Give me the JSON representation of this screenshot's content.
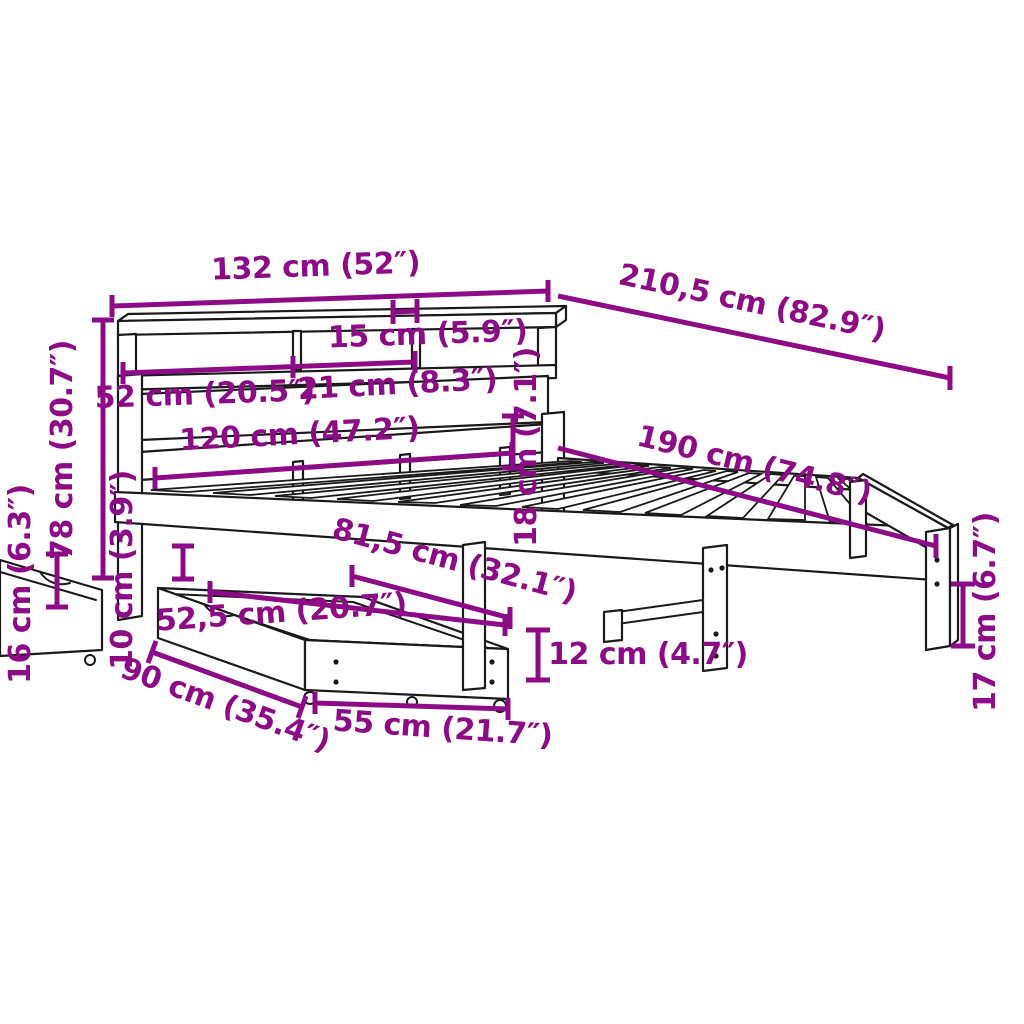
{
  "colors": {
    "dimension": "#8e0b87",
    "line_art": "#1a1a1a",
    "background": "#ffffff"
  },
  "dims": [
    {
      "id": "headboard-width",
      "label": "132 cm (52″)"
    },
    {
      "id": "total-length",
      "label": "210,5 cm (82.9″)"
    },
    {
      "id": "shelf-slot-width",
      "label": "15 cm (5.9″)"
    },
    {
      "id": "shelf-left-compartment",
      "label": "52 cm (20.5″)"
    },
    {
      "id": "shelf-mid-compartment",
      "label": "21 cm (8.3″)"
    },
    {
      "id": "inner-width",
      "label": "120 cm (47.2″)"
    },
    {
      "id": "frame-height",
      "label": "18 cm (7.1″)"
    },
    {
      "id": "mattress-length",
      "label": "190 cm (74.8″)"
    },
    {
      "id": "headboard-height",
      "label": "78 cm (30.7″)"
    },
    {
      "id": "ground-clearance",
      "label": "16 cm (6.3″)"
    },
    {
      "id": "gap-under-rail",
      "label": "10 cm (3.9″)"
    },
    {
      "id": "underbed-depth",
      "label": "81,5 cm (32.1″)"
    },
    {
      "id": "drawer-inner-width",
      "label": "52,5 cm (20.7″)"
    },
    {
      "id": "drawer-depth",
      "label": "90 cm (35.4″)"
    },
    {
      "id": "drawer-front-width",
      "label": "55 cm (21.7″)"
    },
    {
      "id": "drawer-height",
      "label": "12 cm (4.7″)"
    },
    {
      "id": "leg-height",
      "label": "17 cm (6.7″)"
    }
  ]
}
